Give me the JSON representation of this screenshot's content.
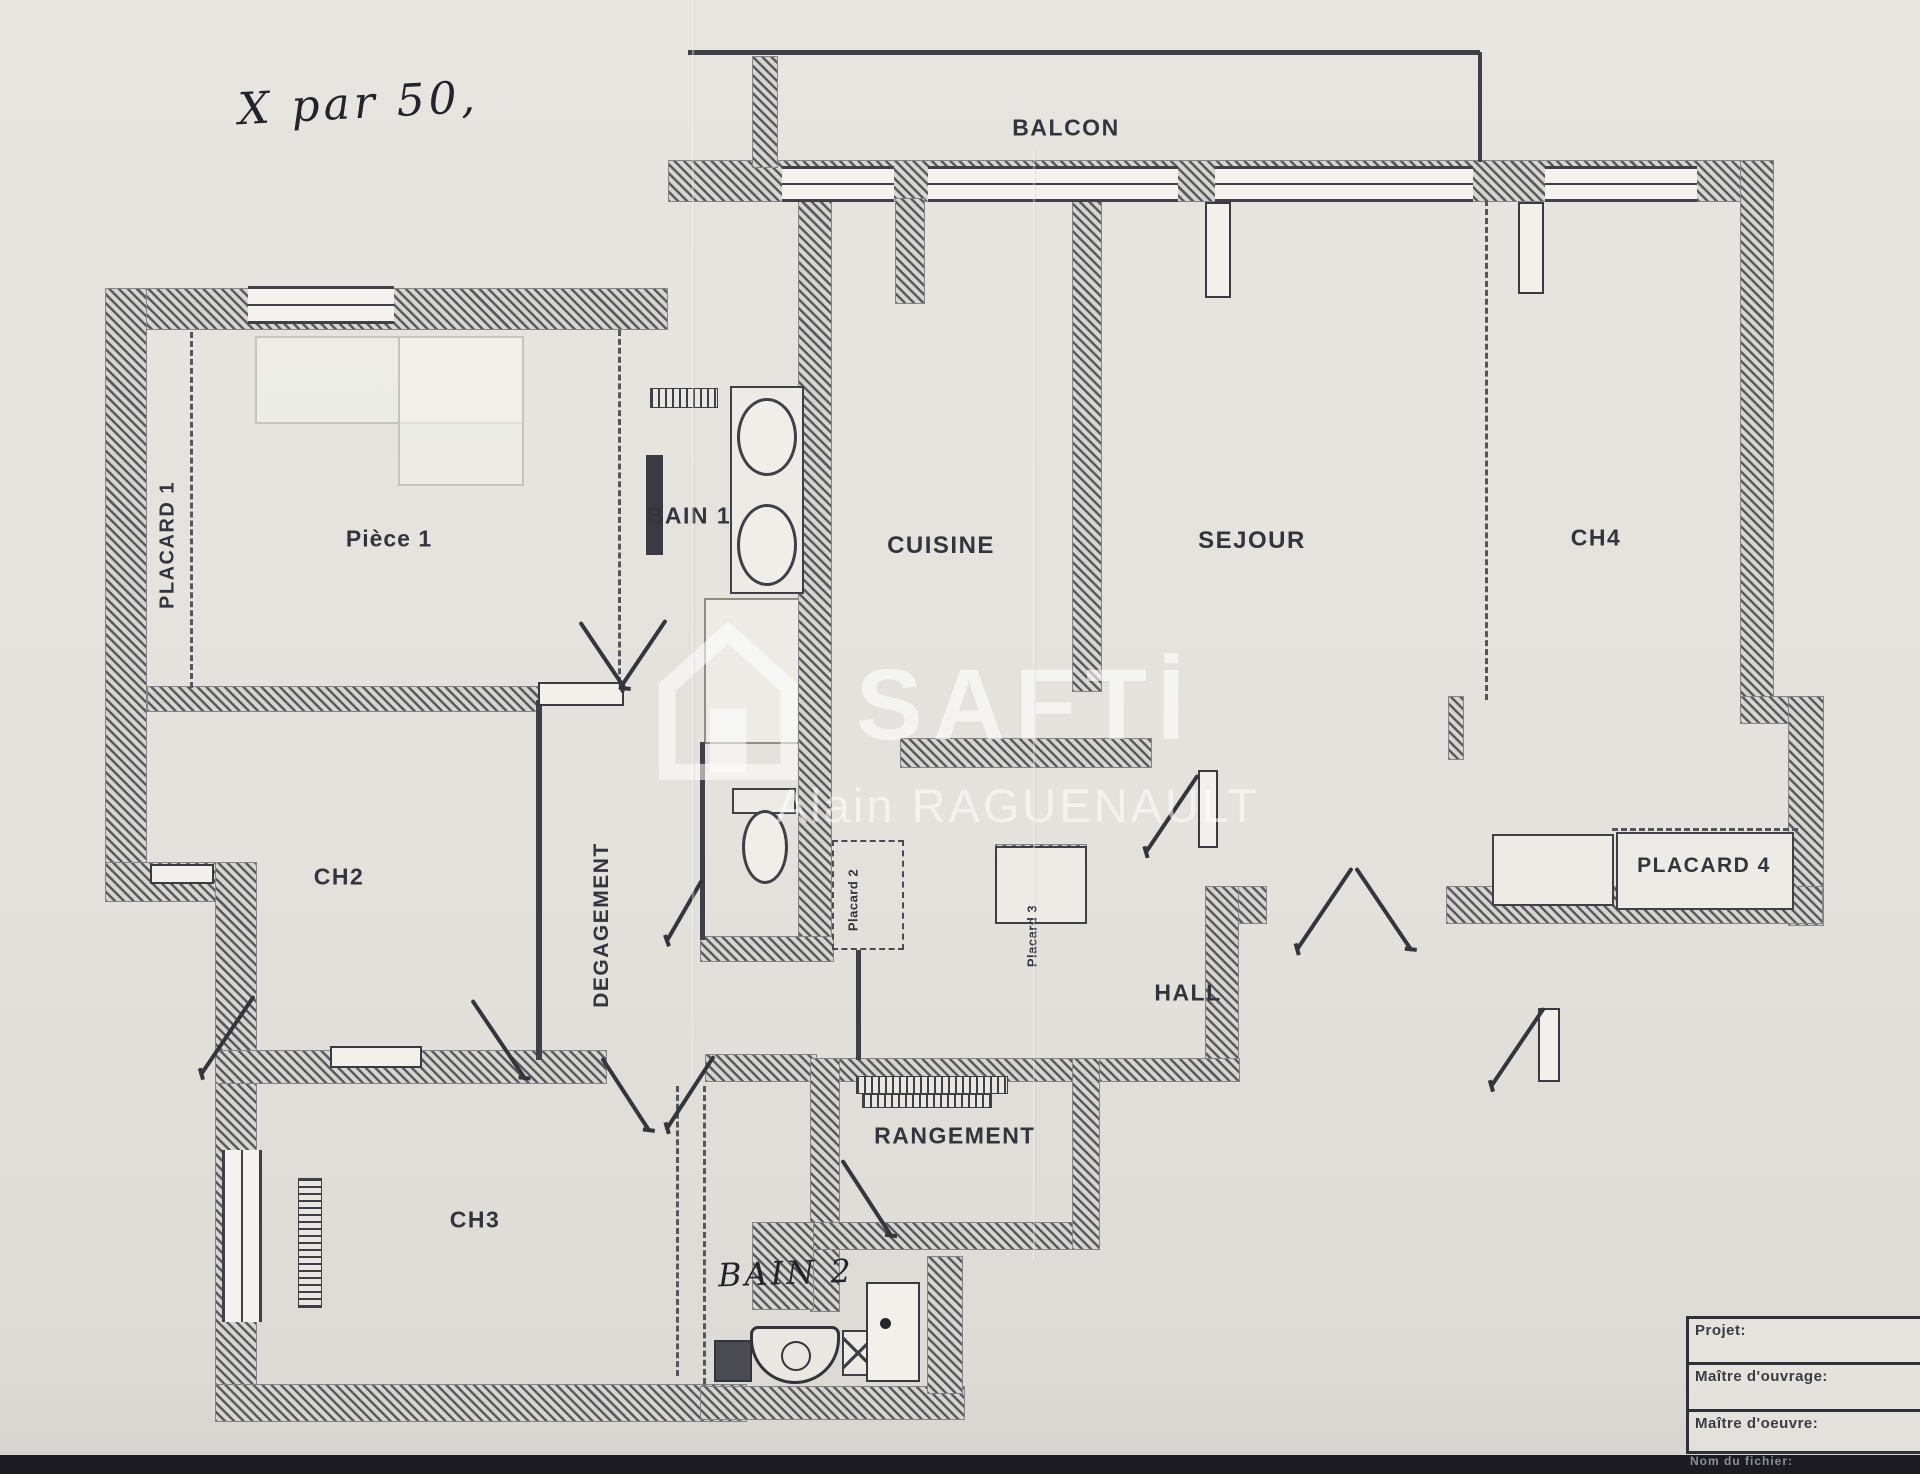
{
  "annotations": {
    "scale_note": "X par 50,",
    "bain2_note": "BAIN 2"
  },
  "watermark": {
    "brand": "SAFTİ",
    "agent_name": "Alain RAGUENAULT"
  },
  "rooms": {
    "balcon": "BALCON",
    "piece1": "Pièce 1",
    "placard1": "PLACARD 1",
    "bain1": "BAIN 1",
    "cuisine": "CUISINE",
    "sejour": "SEJOUR",
    "ch4": "CH4",
    "placard4": "PLACARD 4",
    "ch2": "CH2",
    "degagement": "DEGAGEMENT",
    "placard2": "Placard 2",
    "placard3": "Placard 3",
    "hall": "HALL",
    "rangement": "RANGEMENT",
    "ch3": "CH3"
  },
  "title_block": {
    "rows": [
      {
        "label": "Projet:"
      },
      {
        "label": "Maître d'ouvrage:"
      },
      {
        "label": "Maître d'oeuvre:"
      }
    ],
    "footer": "Nom du fichier:"
  },
  "colors": {
    "paper": "#e4e2dc",
    "ink": "#34343f",
    "wall_hatch": "#5a5a61",
    "watermark": "#ffffff",
    "scan_strip": "#1b1b21"
  }
}
